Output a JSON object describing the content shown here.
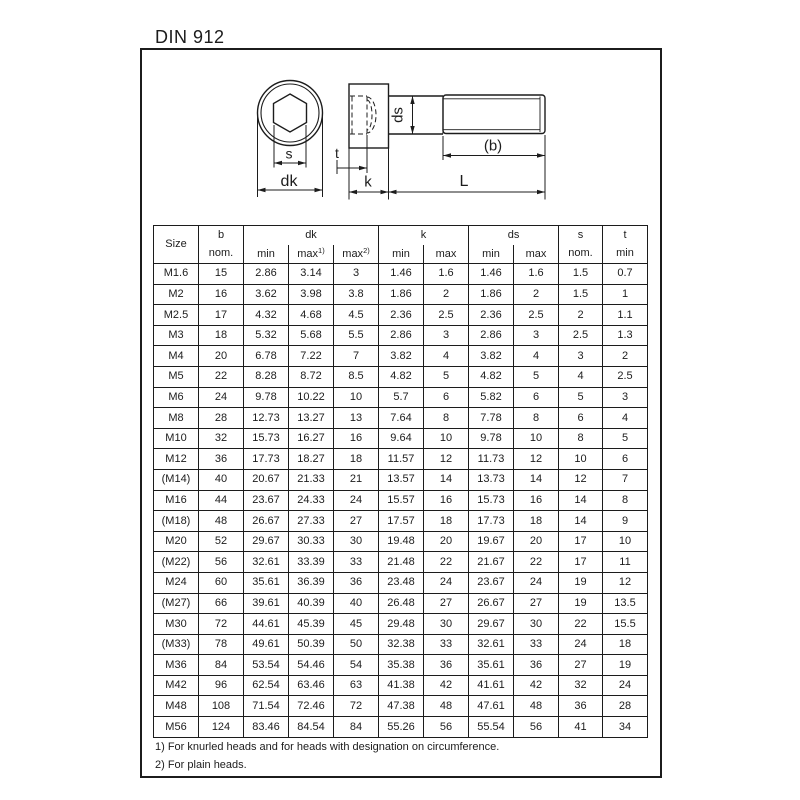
{
  "page": {
    "title": "DIN 912"
  },
  "colors": {
    "ink": "#1c1c1c",
    "background": "#ffffff"
  },
  "drawing": {
    "labels": {
      "s": "s",
      "dk": "dk",
      "t": "t",
      "k": "k",
      "L": "L",
      "ds": "ds",
      "b": "(b)"
    }
  },
  "table": {
    "header": {
      "size": "Size",
      "b": "b",
      "b_sub": "nom.",
      "dk": "dk",
      "dk_min": "min",
      "dk_max1": "max",
      "dk_max1_sup": "1)",
      "dk_max2": "max",
      "dk_max2_sup": "2)",
      "k": "k",
      "k_min": "min",
      "k_max": "max",
      "ds": "ds",
      "ds_min": "min",
      "ds_max": "max",
      "s": "s",
      "s_sub": "nom.",
      "t": "t",
      "t_sub": "min"
    },
    "rows": [
      [
        "M1.6",
        "15",
        "2.86",
        "3.14",
        "3",
        "1.46",
        "1.6",
        "1.46",
        "1.6",
        "1.5",
        "0.7"
      ],
      [
        "M2",
        "16",
        "3.62",
        "3.98",
        "3.8",
        "1.86",
        "2",
        "1.86",
        "2",
        "1.5",
        "1"
      ],
      [
        "M2.5",
        "17",
        "4.32",
        "4.68",
        "4.5",
        "2.36",
        "2.5",
        "2.36",
        "2.5",
        "2",
        "1.1"
      ],
      [
        "M3",
        "18",
        "5.32",
        "5.68",
        "5.5",
        "2.86",
        "3",
        "2.86",
        "3",
        "2.5",
        "1.3"
      ],
      [
        "M4",
        "20",
        "6.78",
        "7.22",
        "7",
        "3.82",
        "4",
        "3.82",
        "4",
        "3",
        "2"
      ],
      [
        "M5",
        "22",
        "8.28",
        "8.72",
        "8.5",
        "4.82",
        "5",
        "4.82",
        "5",
        "4",
        "2.5"
      ],
      [
        "M6",
        "24",
        "9.78",
        "10.22",
        "10",
        "5.7",
        "6",
        "5.82",
        "6",
        "5",
        "3"
      ],
      [
        "M8",
        "28",
        "12.73",
        "13.27",
        "13",
        "7.64",
        "8",
        "7.78",
        "8",
        "6",
        "4"
      ],
      [
        "M10",
        "32",
        "15.73",
        "16.27",
        "16",
        "9.64",
        "10",
        "9.78",
        "10",
        "8",
        "5"
      ],
      [
        "M12",
        "36",
        "17.73",
        "18.27",
        "18",
        "11.57",
        "12",
        "11.73",
        "12",
        "10",
        "6"
      ],
      [
        "(M14)",
        "40",
        "20.67",
        "21.33",
        "21",
        "13.57",
        "14",
        "13.73",
        "14",
        "12",
        "7"
      ],
      [
        "M16",
        "44",
        "23.67",
        "24.33",
        "24",
        "15.57",
        "16",
        "15.73",
        "16",
        "14",
        "8"
      ],
      [
        "(M18)",
        "48",
        "26.67",
        "27.33",
        "27",
        "17.57",
        "18",
        "17.73",
        "18",
        "14",
        "9"
      ],
      [
        "M20",
        "52",
        "29.67",
        "30.33",
        "30",
        "19.48",
        "20",
        "19.67",
        "20",
        "17",
        "10"
      ],
      [
        "(M22)",
        "56",
        "32.61",
        "33.39",
        "33",
        "21.48",
        "22",
        "21.67",
        "22",
        "17",
        "11"
      ],
      [
        "M24",
        "60",
        "35.61",
        "36.39",
        "36",
        "23.48",
        "24",
        "23.67",
        "24",
        "19",
        "12"
      ],
      [
        "(M27)",
        "66",
        "39.61",
        "40.39",
        "40",
        "26.48",
        "27",
        "26.67",
        "27",
        "19",
        "13.5"
      ],
      [
        "M30",
        "72",
        "44.61",
        "45.39",
        "45",
        "29.48",
        "30",
        "29.67",
        "30",
        "22",
        "15.5"
      ],
      [
        "(M33)",
        "78",
        "49.61",
        "50.39",
        "50",
        "32.38",
        "33",
        "32.61",
        "33",
        "24",
        "18"
      ],
      [
        "M36",
        "84",
        "53.54",
        "54.46",
        "54",
        "35.38",
        "36",
        "35.61",
        "36",
        "27",
        "19"
      ],
      [
        "M42",
        "96",
        "62.54",
        "63.46",
        "63",
        "41.38",
        "42",
        "41.61",
        "42",
        "32",
        "24"
      ],
      [
        "M48",
        "108",
        "71.54",
        "72.46",
        "72",
        "47.38",
        "48",
        "47.61",
        "48",
        "36",
        "28"
      ],
      [
        "M56",
        "124",
        "83.46",
        "84.54",
        "84",
        "55.26",
        "56",
        "55.54",
        "56",
        "41",
        "34"
      ]
    ]
  },
  "footnotes": [
    "1) For knurled heads and for heads with designation on circumference.",
    "2) For plain heads."
  ]
}
